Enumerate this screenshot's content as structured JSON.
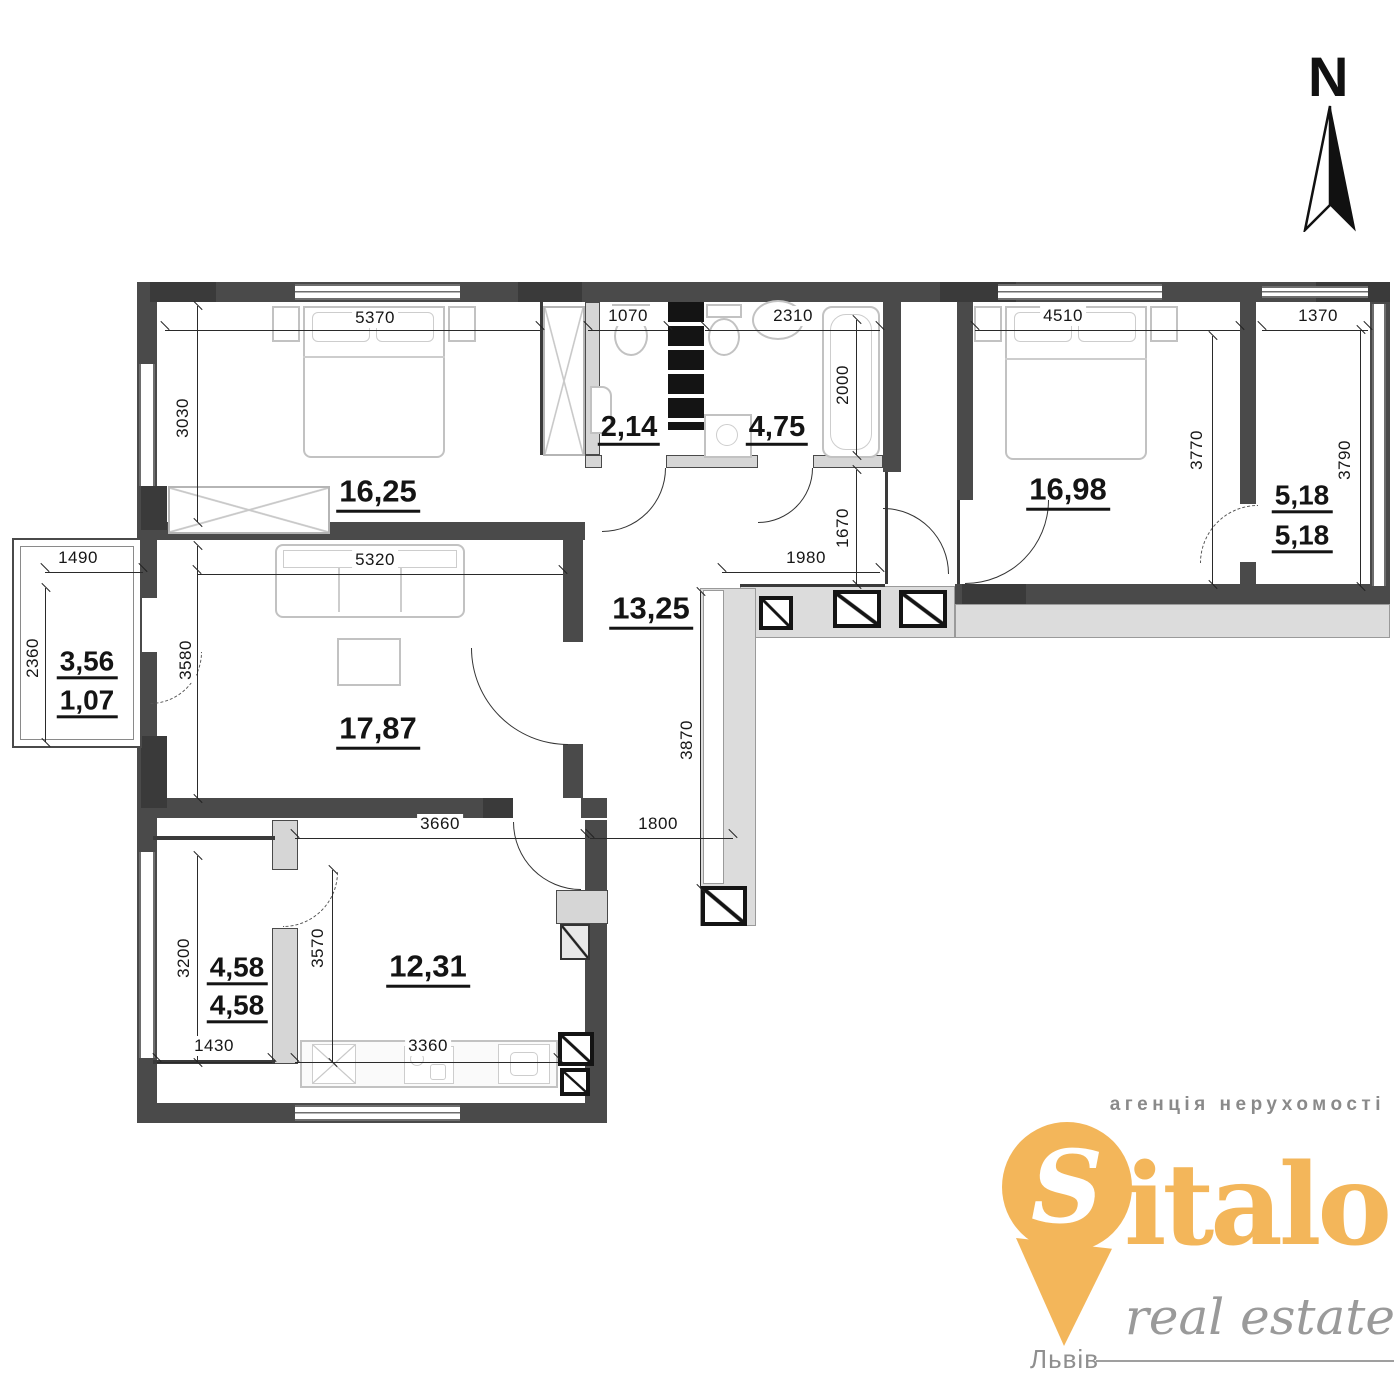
{
  "palette": {
    "wall_dark": "#4a4a4a",
    "wall_light": "#d6d6d6",
    "corridor": "#dcdcdc",
    "shaft_black": "#141414",
    "logo_orange": "#f3b65a",
    "logo_gray": "#9a9a9a"
  },
  "north": {
    "label": "N"
  },
  "areas": {
    "bedroom1": "16,25",
    "wc": "2,14",
    "bathroom": "4,75",
    "bedroom2": "16,98",
    "balcony_right_top": "5,18",
    "balcony_right_bottom": "5,18",
    "loggia_left_top": "3,56",
    "loggia_left_bottom": "1,07",
    "living_room": "17,87",
    "hallway": "13,25",
    "balcony_bottom_top": "4,58",
    "balcony_bottom_bottom": "4,58",
    "kitchen": "12,31"
  },
  "dims": {
    "bedroom1_width": "5370",
    "wc_width": "1070",
    "bathroom_width": "2310",
    "bedroom2_width": "4510",
    "balcony_right_width": "1370",
    "bedroom1_depth": "3030",
    "bathtub_length": "2000",
    "entry_passage": "1670",
    "bedroom2_depth": "3770",
    "balcony_right_depth": "3790",
    "loggia_width": "1490",
    "loggia_depth": "2360",
    "living_width": "5320",
    "living_depth": "3580",
    "hall_width": "1980",
    "hall_depth": "3870",
    "hall_bottom": "1800",
    "kitchen_top_width": "3660",
    "balcony_bottom_depth": "3200",
    "kitchen_depth": "3570",
    "balcony_bottom_width": "1430",
    "kitchen_width": "3360"
  },
  "logo": {
    "tagline": "агенція нерухомості",
    "brand_initial": "S",
    "brand_rest": "italo",
    "subtitle": "real estate",
    "city": "Львів"
  }
}
